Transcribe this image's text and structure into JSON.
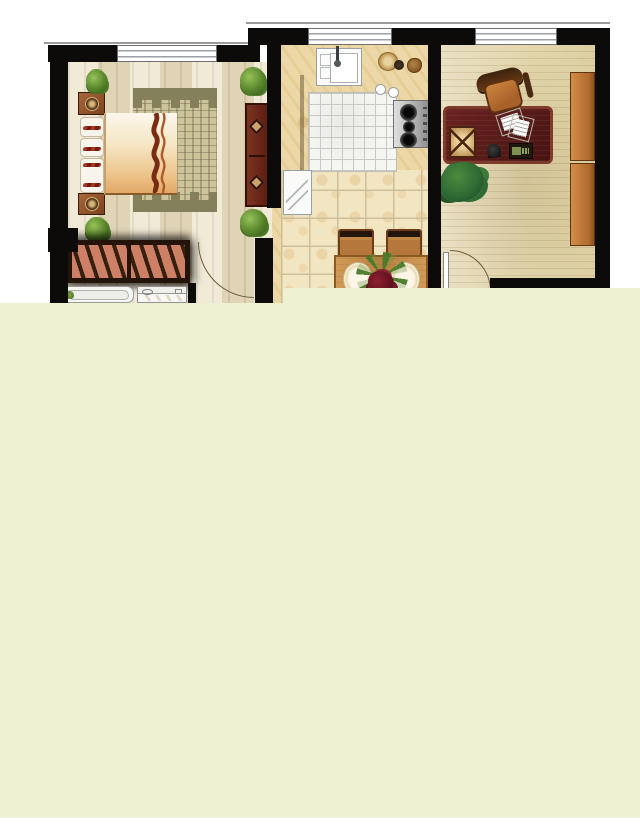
{
  "scene": {
    "kind": "apartment-floor-plan-render",
    "description": "Top-down colored architectural floor plan occupying the upper-left area; the rest of the canvas is a flat pale-yellow field with no text or UI chrome.",
    "visible_text": [],
    "rooms": [
      {
        "id": "bedroom",
        "furniture": [
          "double-bed-with-pillows",
          "area-rug-castellated-border",
          "nightstand-top",
          "nightstand-bottom",
          "side-dresser",
          "wardrobe-with-hangers",
          "potted-plant-corner x4",
          "window",
          "door-swing-arc"
        ]
      },
      {
        "id": "kitchen-dining",
        "furniture": [
          "counter-run",
          "sink-with-faucet",
          "bowls-and-plates",
          "gas-stove-3-burners",
          "tiled-floor-mat",
          "refrigerator",
          "floral-floor-tiles",
          "dining-table",
          "dining-chair x2",
          "table-plates x2",
          "flower-bouquet-centerpiece",
          "window"
        ]
      },
      {
        "id": "study",
        "furniture": [
          "executive-desk",
          "desk-lamp",
          "papers",
          "telephone",
          "keypad-device",
          "office-chair",
          "potted-plant-large",
          "bookshelf-panel x2",
          "window",
          "door-swing-arc-with-leaf"
        ]
      },
      {
        "id": "bathroom-partial",
        "furniture": [
          "bathtub-cropped",
          "washing-machine-cropped"
        ]
      }
    ],
    "windows_count": 3,
    "door_arcs_count": 2,
    "cropped_by_overlay": true
  },
  "colors": {
    "wall": "#0d0b09",
    "paleMask": "#eef0d2",
    "bedFloor": "#eae2c8",
    "counter": "#ecd8a6",
    "mat": "#f5f5f2",
    "matLine": "#c9c9c3",
    "tile": "#f2e6c2",
    "tileLine": "#cfbf98",
    "rugBase": "#cdc49c",
    "rugBand": "#85805c",
    "salmon": "#cd8066",
    "slat": "#35200f",
    "doorArc": "#6b5b3f"
  }
}
